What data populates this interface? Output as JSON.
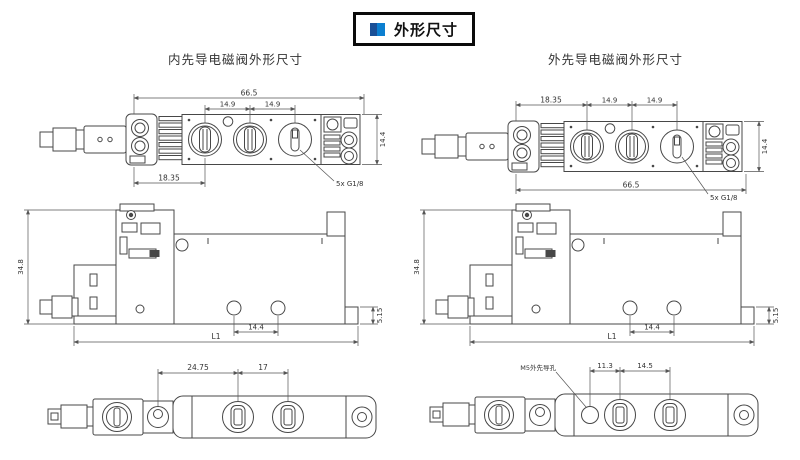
{
  "title_box": {
    "label": "外形尺寸"
  },
  "headers": {
    "left": "内先导电磁阀外形尺寸",
    "right": "外先导电磁阀外形尺寸"
  },
  "drawings": {
    "internal_top": {
      "overall_width": "66.5",
      "port_pitch_a": "14.9",
      "port_pitch_b": "14.9",
      "left_offset": "18.35",
      "body_height": "14.4",
      "ports_label": "5x G1/8"
    },
    "external_top": {
      "left_offset": "18.35",
      "port_pitch_a": "14.9",
      "port_pitch_b": "14.9",
      "overall_width": "66.5",
      "body_height": "14.4",
      "ports_label": "5x G1/8"
    },
    "internal_side": {
      "overall_height": "34.8",
      "length": "L1",
      "hole_pitch": "14.4",
      "base_height": "5.15"
    },
    "external_side": {
      "overall_height": "34.8",
      "length": "L1",
      "hole_pitch": "14.4",
      "base_height": "5.15"
    },
    "internal_bottom": {
      "offset": "24.75",
      "port_pitch": "17"
    },
    "external_bottom": {
      "pilot_port_label": "M5外先导孔",
      "offset": "11.3",
      "port_pitch": "14.5"
    }
  },
  "colors": {
    "accent_dark": "#1a4f96",
    "accent_light": "#0c7fd0",
    "line": "#474747",
    "dim_line": "#555555",
    "text": "#333333"
  }
}
